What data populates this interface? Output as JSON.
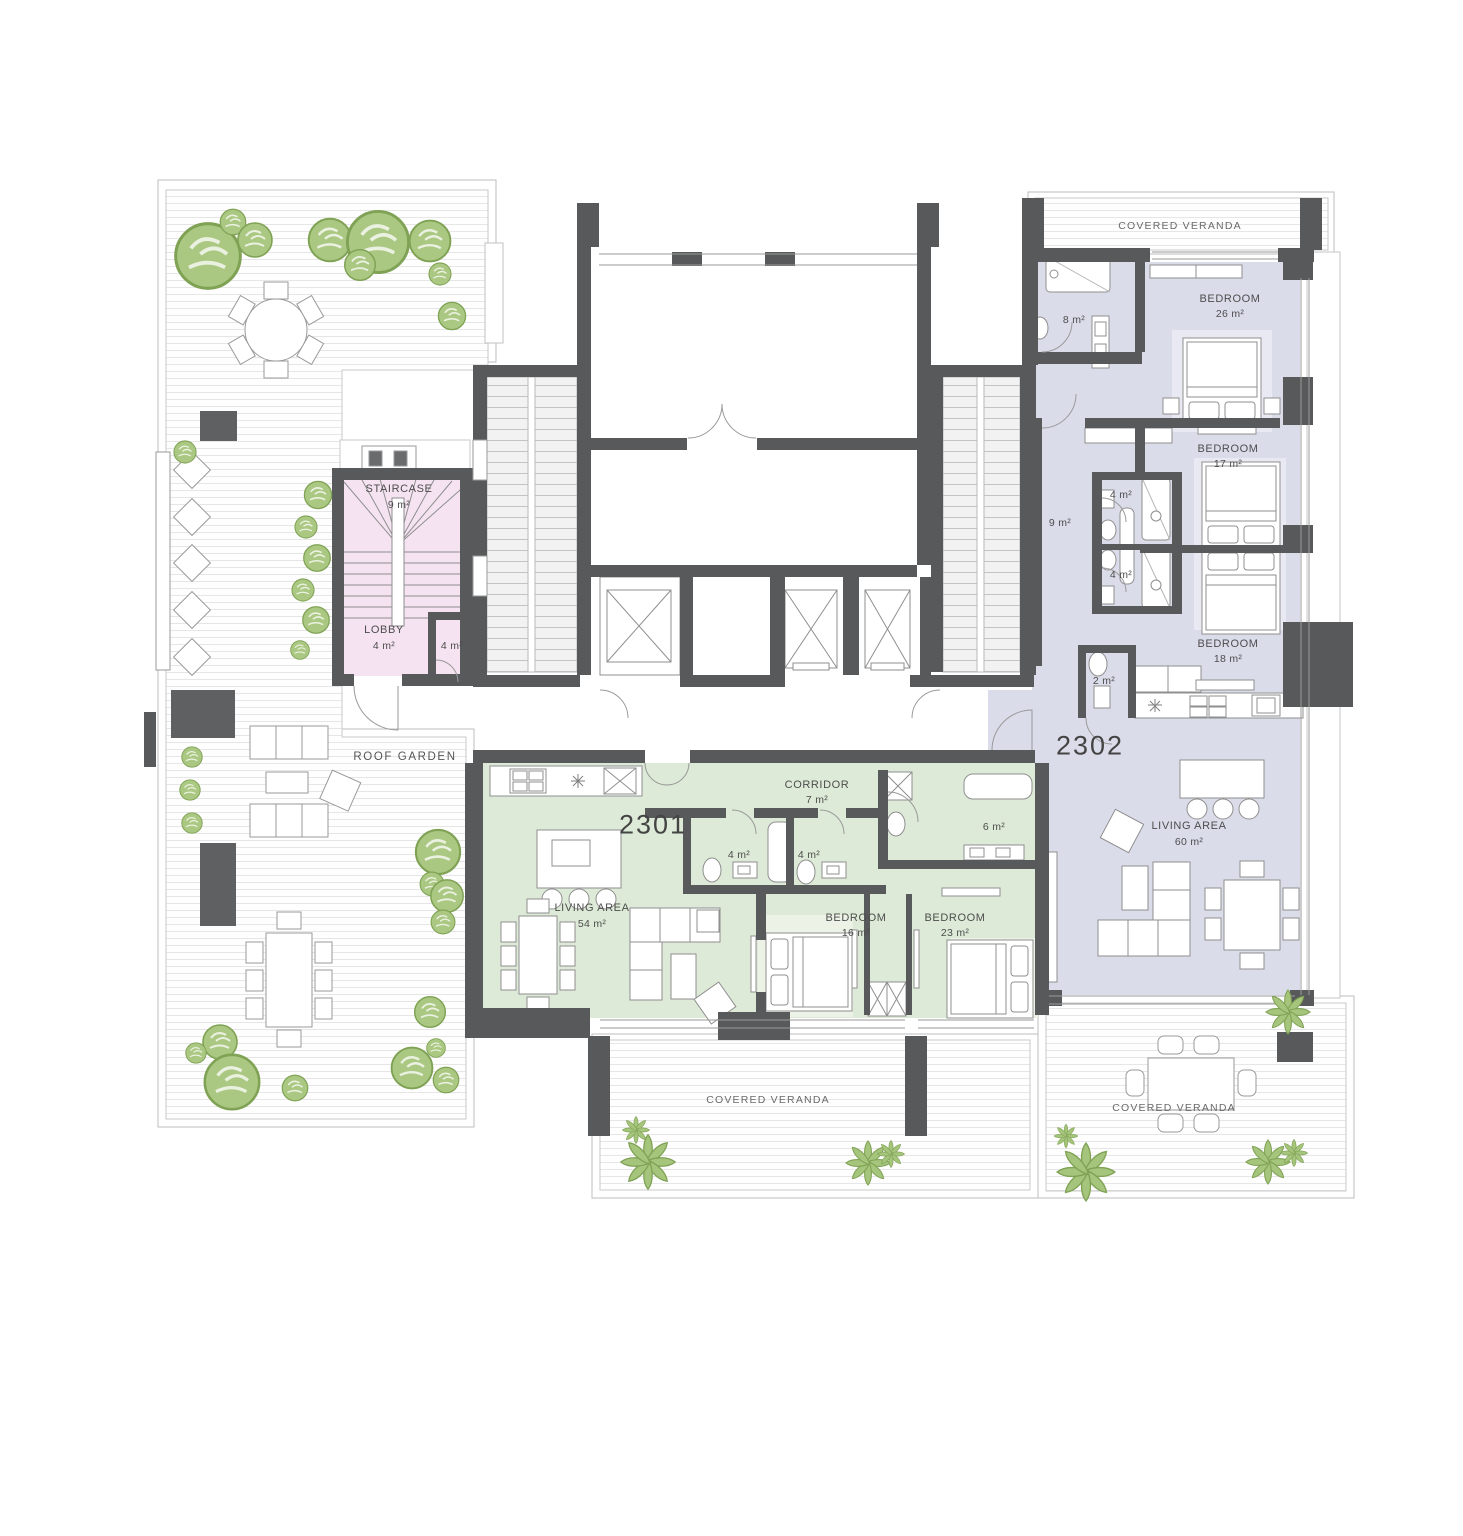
{
  "outdoor": {
    "roof_garden": {
      "label": "ROOF GARDEN"
    },
    "veranda_top_right": {
      "label": "COVERED VERANDA"
    },
    "veranda_bottom_center": {
      "label": "COVERED VERANDA"
    },
    "veranda_bottom_right": {
      "label": "COVERED VERANDA"
    }
  },
  "common_areas": {
    "staircase": {
      "name": "STAIRCASE",
      "area": "9 m²"
    },
    "lobby": {
      "name": "LOBBY",
      "area": "4 m²"
    },
    "lobby_wc": {
      "area": "4 m²"
    }
  },
  "unit_2301": {
    "number": "2301",
    "corridor": {
      "name": "CORRIDOR",
      "area": "7 m²"
    },
    "living": {
      "name": "LIVING  AREA",
      "area": "54 m²"
    },
    "bedroom_16": {
      "name": "BEDROOM",
      "area": "16 m²"
    },
    "bedroom_23": {
      "name": "BEDROOM",
      "area": "23 m²"
    },
    "bath_a": {
      "area": "4 m²"
    },
    "bath_b": {
      "area": "4 m²"
    },
    "bath_6": {
      "area": "6 m²"
    }
  },
  "unit_2302": {
    "number": "2302",
    "living": {
      "name": "LIVING AREA",
      "area": "60 m²"
    },
    "bedroom_26": {
      "name": "BEDROOM",
      "area": "26 m²"
    },
    "bedroom_17": {
      "name": "BEDROOM",
      "area": "17 m²"
    },
    "bedroom_18": {
      "name": "BEDROOM",
      "area": "18 m²"
    },
    "bath_8": {
      "area": "8 m²"
    },
    "hall_9": {
      "area": "9 m²"
    },
    "bath_a": {
      "area": "4 m²"
    },
    "bath_b": {
      "area": "4 m²"
    },
    "wc_2": {
      "area": "2 m²"
    }
  },
  "colors": {
    "wall": "#58595b",
    "unit_2301_fill": "#ddead7",
    "unit_2302_fill": "#dbdcea",
    "staircase_fill": "#f5e3f1",
    "tree_fill": "#abc883",
    "tree_stroke": "#7fa254"
  }
}
